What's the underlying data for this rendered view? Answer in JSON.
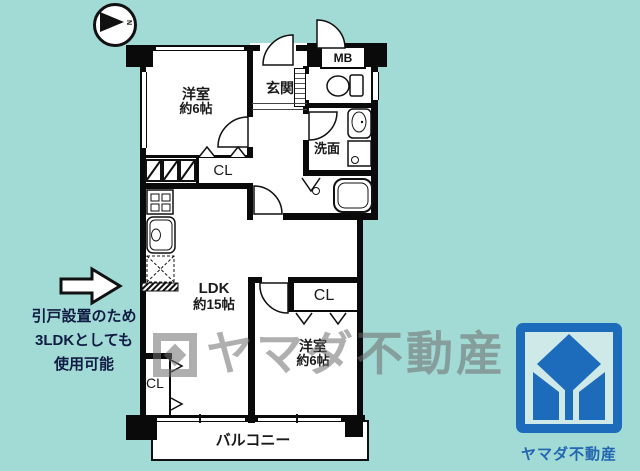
{
  "page": {
    "background_color": "#a2dad5"
  },
  "compass": {
    "label": "N"
  },
  "plan": {
    "bedroom1": {
      "name": "洋室",
      "size": "約6帖"
    },
    "entrance": {
      "label": "玄関"
    },
    "meter_box": {
      "label": "MB"
    },
    "washroom": {
      "label": "洗面"
    },
    "ldk": {
      "name": "LDK",
      "size": "約15帖"
    },
    "bedroom2": {
      "name": "洋室",
      "size": "約6帖"
    },
    "balcony": {
      "label": "バルコニー"
    },
    "closet_bedroom1": {
      "label": "CL"
    },
    "closet_bedroom2": {
      "label": "CL"
    },
    "closet_ldk": {
      "label": "CL"
    }
  },
  "annotation": {
    "lines": [
      "引戸設置のため",
      "3LDKとしても",
      "使用可能"
    ],
    "color": "#111c44"
  },
  "watermark": {
    "text": "ヤマダ不動産"
  },
  "logo": {
    "company_name": "ヤマダ不動産",
    "primary_color": "#1d6cbc",
    "field_color": "#cfe9e8"
  }
}
